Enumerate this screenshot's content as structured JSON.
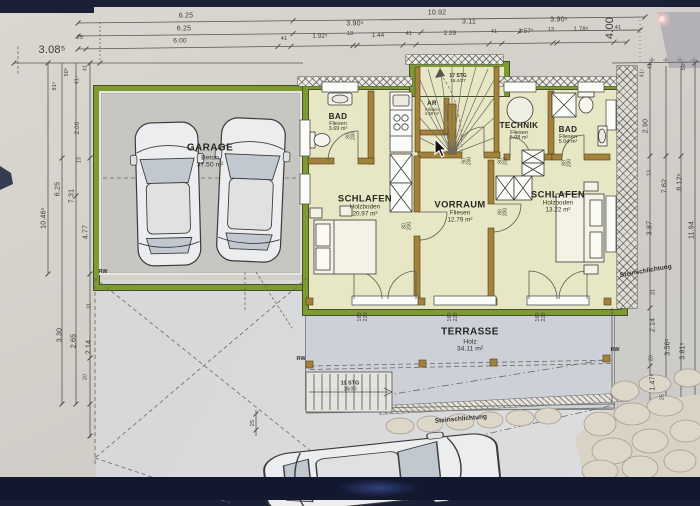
{
  "colors": {
    "paper": "#d5d2cb",
    "navy": "#1a2036",
    "navy2": "#121830",
    "green": "#7d9b31",
    "wall": "#a5823c",
    "room": "#e8e7c5",
    "garage": "#c8c6c2",
    "terrace": "#cdd1d7",
    "drive": "#d6d7d9",
    "stone": "#d9d3c5"
  },
  "labels": [
    {
      "k": "dim",
      "t": "6.25",
      "x": 186,
      "y": 10
    },
    {
      "k": "dim",
      "t": "10.92",
      "x": 437,
      "y": 7
    },
    {
      "k": "dim",
      "t": "6.25",
      "x": 184,
      "y": 23
    },
    {
      "k": "dim",
      "t": "3.90⁵",
      "x": 355,
      "y": 18
    },
    {
      "k": "dim",
      "t": "3.11",
      "x": 469,
      "y": 16
    },
    {
      "k": "dim",
      "t": "3.90⁵",
      "x": 559,
      "y": 14
    },
    {
      "k": "dim",
      "t": "25",
      "x": 80,
      "y": 33,
      "fs": 5.5
    },
    {
      "k": "dim",
      "t": "6.00",
      "x": 180,
      "y": 36,
      "fs": 6.5
    },
    {
      "k": "dim",
      "t": "41",
      "x": 284,
      "y": 33.5,
      "fs": 5.5
    },
    {
      "k": "dim",
      "t": "1.92⁵",
      "x": 320,
      "y": 31,
      "fs": 6
    },
    {
      "k": "dim",
      "t": "13",
      "x": 350,
      "y": 28.5,
      "fs": 5.5
    },
    {
      "k": "dim",
      "t": "1.44",
      "x": 378,
      "y": 29.5,
      "fs": 6
    },
    {
      "k": "dim",
      "t": "41",
      "x": 409,
      "y": 29,
      "fs": 5.5
    },
    {
      "k": "dim",
      "t": "2.29",
      "x": 450,
      "y": 28,
      "fs": 6
    },
    {
      "k": "dim",
      "t": "41",
      "x": 494,
      "y": 27,
      "fs": 5.5
    },
    {
      "k": "dim",
      "t": "1.57⁵",
      "x": 526,
      "y": 26,
      "fs": 6
    },
    {
      "k": "dim",
      "t": "13",
      "x": 551,
      "y": 24.5,
      "fs": 5.5
    },
    {
      "k": "dim",
      "t": "1.78⁵",
      "x": 581,
      "y": 24,
      "fs": 6
    },
    {
      "k": "dim",
      "t": "41",
      "x": 618,
      "y": 23,
      "fs": 5.5
    },
    {
      "k": "dim",
      "t": "3.08⁵",
      "x": 52,
      "y": 45,
      "fs": 11
    },
    {
      "k": "dim",
      "t": "4.00",
      "x": 611,
      "y": 22,
      "fs": 11,
      "rot": -90
    },
    {
      "k": "dim",
      "t": "91⁵",
      "x": 56,
      "y": 80,
      "fs": 5.5,
      "rot": -90
    },
    {
      "k": "dim",
      "t": "50⁵",
      "x": 68,
      "y": 66,
      "fs": 5.5,
      "rot": -90
    },
    {
      "k": "dim",
      "t": "41⁵",
      "x": 78,
      "y": 74,
      "fs": 5,
      "rot": -90
    },
    {
      "k": "dim",
      "t": "41",
      "x": 86,
      "y": 62,
      "fs": 5,
      "rot": -90
    },
    {
      "k": "dim",
      "t": "2.00",
      "x": 78,
      "y": 122,
      "fs": 6,
      "rot": -90
    },
    {
      "k": "dim",
      "t": "13",
      "x": 80,
      "y": 154,
      "fs": 5,
      "rot": -90
    },
    {
      "k": "dim",
      "t": "10.46⁵",
      "x": 44,
      "y": 212,
      "fs": 7,
      "rot": -90
    },
    {
      "k": "dim",
      "t": "6.25",
      "x": 58,
      "y": 183,
      "fs": 7,
      "rot": -90
    },
    {
      "k": "dim",
      "t": "7.31",
      "x": 72,
      "y": 190,
      "fs": 7,
      "rot": -90
    },
    {
      "k": "dim",
      "t": "4.77",
      "x": 86,
      "y": 226,
      "fs": 7,
      "rot": -90
    },
    {
      "k": "dim",
      "t": "31",
      "x": 90,
      "y": 300,
      "fs": 5,
      "rot": -90
    },
    {
      "k": "dim",
      "t": "3.30",
      "x": 60,
      "y": 329,
      "fs": 7,
      "rot": -90
    },
    {
      "k": "dim",
      "t": "2.65",
      "x": 74,
      "y": 335,
      "fs": 7,
      "rot": -90
    },
    {
      "k": "dim",
      "t": "2.14",
      "x": 89,
      "y": 341,
      "fs": 7,
      "rot": -90
    },
    {
      "k": "dim",
      "t": "20",
      "x": 86,
      "y": 371,
      "fs": 5,
      "rot": -90
    },
    {
      "k": "dim",
      "t": "25",
      "x": 254,
      "y": 417,
      "fs": 5.5,
      "rot": -90
    },
    {
      "k": "dim",
      "t": "41⁵",
      "x": 643,
      "y": 67,
      "fs": 5,
      "rot": -90
    },
    {
      "k": "dim",
      "t": "41",
      "x": 651,
      "y": 60,
      "fs": 5,
      "rot": -90
    },
    {
      "k": "dim",
      "t": "50⁵",
      "x": 685,
      "y": 60,
      "fs": 5.5,
      "rot": -90
    },
    {
      "k": "dim",
      "t": "2.90",
      "x": 646,
      "y": 120,
      "fs": 7,
      "rot": -90
    },
    {
      "k": "dim",
      "t": "13",
      "x": 650,
      "y": 167,
      "fs": 5,
      "rot": -90
    },
    {
      "k": "dim",
      "t": "7.62",
      "x": 665,
      "y": 180,
      "fs": 7,
      "rot": -90
    },
    {
      "k": "dim",
      "t": "8.12⁵",
      "x": 680,
      "y": 176,
      "fs": 7,
      "rot": -90
    },
    {
      "k": "dim",
      "t": "3.87",
      "x": 650,
      "y": 222,
      "fs": 7,
      "rot": -90
    },
    {
      "k": "dim",
      "t": "11.94",
      "x": 692,
      "y": 224,
      "fs": 7,
      "rot": -90
    },
    {
      "k": "dim",
      "t": "31",
      "x": 654,
      "y": 286,
      "fs": 5,
      "rot": -90
    },
    {
      "k": "dim",
      "t": "2.14",
      "x": 653,
      "y": 319,
      "fs": 7,
      "rot": -90
    },
    {
      "k": "dim",
      "t": "3.56⁵",
      "x": 668,
      "y": 341,
      "fs": 7,
      "rot": -90
    },
    {
      "k": "dim",
      "t": "3.81⁵",
      "x": 683,
      "y": 345,
      "fs": 7,
      "rot": -90
    },
    {
      "k": "dim",
      "t": "20",
      "x": 652,
      "y": 352,
      "fs": 5,
      "rot": -90
    },
    {
      "k": "dim",
      "t": "1.47⁵",
      "x": 653,
      "y": 376,
      "fs": 7,
      "rot": -90
    },
    {
      "k": "dim",
      "t": "25",
      "x": 663,
      "y": 391,
      "fs": 5,
      "rot": -90
    },
    {
      "k": "door",
      "t": [
        "80",
        "200"
      ],
      "x": 352,
      "y": 130,
      "fs": 5,
      "rot": -90
    },
    {
      "k": "door",
      "t": [
        "80",
        "200"
      ],
      "x": 408,
      "y": 220,
      "fs": 5,
      "rot": -90
    },
    {
      "k": "door",
      "t": [
        "90",
        "200"
      ],
      "x": 468,
      "y": 155,
      "fs": 5,
      "rot": -90
    },
    {
      "k": "door",
      "t": [
        "80",
        "200"
      ],
      "x": 504,
      "y": 155,
      "fs": 5,
      "rot": -90
    },
    {
      "k": "door",
      "t": [
        "80",
        "200"
      ],
      "x": 568,
      "y": 157,
      "fs": 5,
      "rot": -90
    },
    {
      "k": "door",
      "t": [
        "80",
        "200"
      ],
      "x": 504,
      "y": 206,
      "fs": 5,
      "rot": -90
    },
    {
      "k": "door",
      "t": [
        "180",
        "220"
      ],
      "x": 364,
      "y": 311,
      "fs": 5.5,
      "rot": -90
    },
    {
      "k": "door",
      "t": [
        "180",
        "220"
      ],
      "x": 454,
      "y": 311,
      "fs": 5.5,
      "rot": -90
    },
    {
      "k": "door",
      "t": [
        "180",
        "220"
      ],
      "x": 542,
      "y": 311,
      "fs": 5.5,
      "rot": -90
    },
    {
      "n": "room-label-garage",
      "k": "room",
      "t": [
        "GARAGE",
        "Beton",
        "37.50 m²"
      ],
      "x": 210,
      "y": 150,
      "fs": 8
    },
    {
      "n": "room-label-bad-left",
      "k": "room",
      "t": [
        "BAD",
        "Fliesen",
        "3.69 m²"
      ],
      "x": 338,
      "y": 117,
      "fs": 6.5
    },
    {
      "n": "room-label-ar",
      "k": "room",
      "t": [
        "AR",
        "Fliesen",
        "4.68 m²"
      ],
      "x": 432,
      "y": 103,
      "fs": 5
    },
    {
      "n": "room-label-technik",
      "k": "room",
      "t": [
        "TECHNIK",
        "Fliesen",
        "5.08 m²"
      ],
      "x": 519,
      "y": 126,
      "fs": 6.5
    },
    {
      "n": "room-label-bad-right",
      "k": "room",
      "t": [
        "BAD",
        "Fliesen",
        "5.04 m²"
      ],
      "x": 568,
      "y": 130,
      "fs": 6.5
    },
    {
      "n": "room-label-schlafen-left",
      "k": "room",
      "t": [
        "SCHLAFEN",
        "Holzboden",
        "20.97 m²"
      ],
      "x": 365,
      "y": 200,
      "fs": 7.5
    },
    {
      "n": "room-label-vorraum",
      "k": "room",
      "t": [
        "VORRAUM",
        "Fliesen",
        "12.79 m²"
      ],
      "x": 460,
      "y": 206,
      "fs": 7.5
    },
    {
      "n": "room-label-schlafen-right",
      "k": "room",
      "t": [
        "SCHLAFEN",
        "Holzboden",
        "13.22 m²"
      ],
      "x": 558,
      "y": 196,
      "fs": 7.5
    },
    {
      "n": "room-label-terrasse",
      "k": "room",
      "t": [
        "TERRASSE",
        "Holz",
        "34.11 m²"
      ],
      "x": 470,
      "y": 334,
      "fs": 8
    },
    {
      "n": "stair-label-interior",
      "k": "ann",
      "t": [
        "17 STG",
        "18,4/27"
      ],
      "x": 458,
      "y": 73,
      "fs": 5
    },
    {
      "n": "stair-label-exterior",
      "k": "ann",
      "t": [
        "11 STG",
        "16/30"
      ],
      "x": 350,
      "y": 381,
      "fs": 5.5
    },
    {
      "n": "annotation-steinschlichtung-right",
      "k": "ann",
      "t": "Steinschlichtung",
      "x": 646,
      "y": 266,
      "fs": 6.5,
      "rot": -10
    },
    {
      "n": "annotation-steinschlichtung-bottom",
      "k": "ann",
      "t": "Steinschlichtung",
      "x": 461,
      "y": 414,
      "fs": 6.5,
      "rot": -5
    },
    {
      "n": "annotation-rw-garage",
      "k": "ann",
      "t": "RW",
      "x": 103,
      "y": 267,
      "fs": 5.5
    },
    {
      "n": "annotation-rw-terrace-left",
      "k": "ann",
      "t": "RW",
      "x": 301,
      "y": 354,
      "fs": 5.5
    },
    {
      "n": "annotation-rw-terrace-right",
      "k": "ann",
      "t": "RW",
      "x": 615,
      "y": 345,
      "fs": 5.5
    }
  ]
}
